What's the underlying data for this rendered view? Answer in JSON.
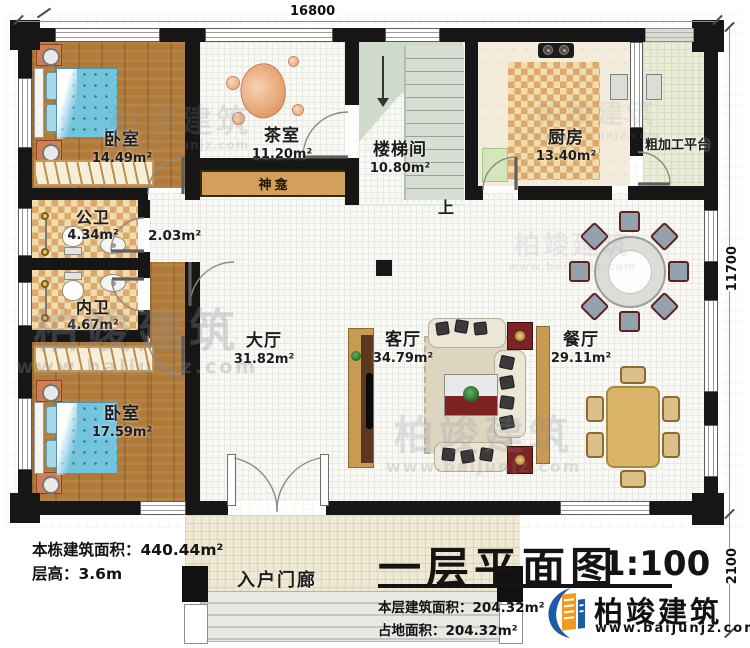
{
  "plan": {
    "title": "一层平面图",
    "scale": "1:100",
    "floor_area_note": "本层建筑面积：204.32m²",
    "footprint_note": "占地面积：204.32m²",
    "total_area_note": "本栋建筑面积：440.44m²",
    "floor_height_note": "层高：3.6m"
  },
  "dimensions": {
    "top": "16800",
    "right": "11700",
    "bottom_right": "2100"
  },
  "rooms": {
    "bedroom_top": {
      "name": "卧室",
      "area": "14.49m²"
    },
    "tea_room": {
      "name": "茶室",
      "area": "11.20m²"
    },
    "stairwell": {
      "name": "楼梯间",
      "area": "10.80m²"
    },
    "kitchen": {
      "name": "厨房",
      "area": "13.40m²"
    },
    "prep_platform": {
      "name": "粗加工平台"
    },
    "shrine": {
      "name": "神龛"
    },
    "public_bath": {
      "name": "公卫",
      "area": "4.34m²"
    },
    "corridor": {
      "area": "2.03m²"
    },
    "private_bath": {
      "name": "内卫",
      "area": "4.67m²"
    },
    "hall": {
      "name": "大厅",
      "area": "31.82m²"
    },
    "living_room": {
      "name": "客厅",
      "area": "34.79m²"
    },
    "dining_room": {
      "name": "餐厅",
      "area": "29.11m²"
    },
    "bedroom_bottom": {
      "name": "卧室",
      "area": "17.59m²"
    },
    "entry_porch": {
      "name": "入户门廊"
    },
    "stairs_up": "上"
  },
  "brand": {
    "name": "柏竣建筑",
    "site": "www.baijunjz.com"
  },
  "colors": {
    "wall": "#161616",
    "wood_floor": "#b07a39",
    "checker_light": "#f0dcae",
    "checker_dark": "#dca96a",
    "tile": "#f8f8f5",
    "stair_green": "#cfd9cc",
    "accent_blue": "#1c5ba8",
    "accent_orange": "#f5991e",
    "cabinet_tan": "#d3a05b"
  }
}
